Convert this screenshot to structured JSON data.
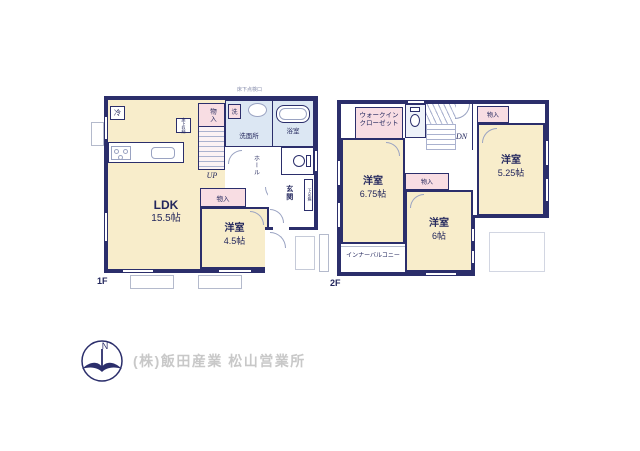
{
  "floor1": {
    "floor_label": "1F",
    "ldk_name": "LDK",
    "ldk_size": "15.5帖",
    "western_room_name": "洋室",
    "western_room_size": "4.5帖",
    "closet_by_stairs": "物入",
    "closet_south": "物入",
    "washroom": "洗面所",
    "laundry": "洗",
    "bath": "浴室",
    "hall": "ホール",
    "entrance": "玄関",
    "shoe_box": "下足箱",
    "refrigerator": "冷",
    "underfloor_storage": "床下収納",
    "underfloor_hatch": "床下点検口",
    "stairs_direction": "UP"
  },
  "floor2": {
    "floor_label": "2F",
    "walk_in_closet": {
      "line1": "ウォークイン",
      "line2": "クローゼット"
    },
    "western_room_675_name": "洋室",
    "western_room_675_size": "6.75帖",
    "western_room_6_name": "洋室",
    "western_room_6_size": "6帖",
    "western_room_525_name": "洋室",
    "western_room_525_size": "5.25帖",
    "closet_northeast": "物入",
    "closet_center": "物入",
    "inner_balcony": "インナーバルコニー",
    "stairs_direction": "DN"
  },
  "footer": {
    "company": "(株)飯田産業 松山営業所",
    "compass_north": "N"
  },
  "colors": {
    "wall": "#2b2e6b",
    "room_cream": "#f8edcb",
    "room_wet": "#dce7f3",
    "room_closet": "#f8dde3",
    "stair_pink": "#fbf2f4",
    "line_gray": "#9aa3c2",
    "label_navy": "#23275d",
    "footer_gray": "#c8c8c8"
  }
}
